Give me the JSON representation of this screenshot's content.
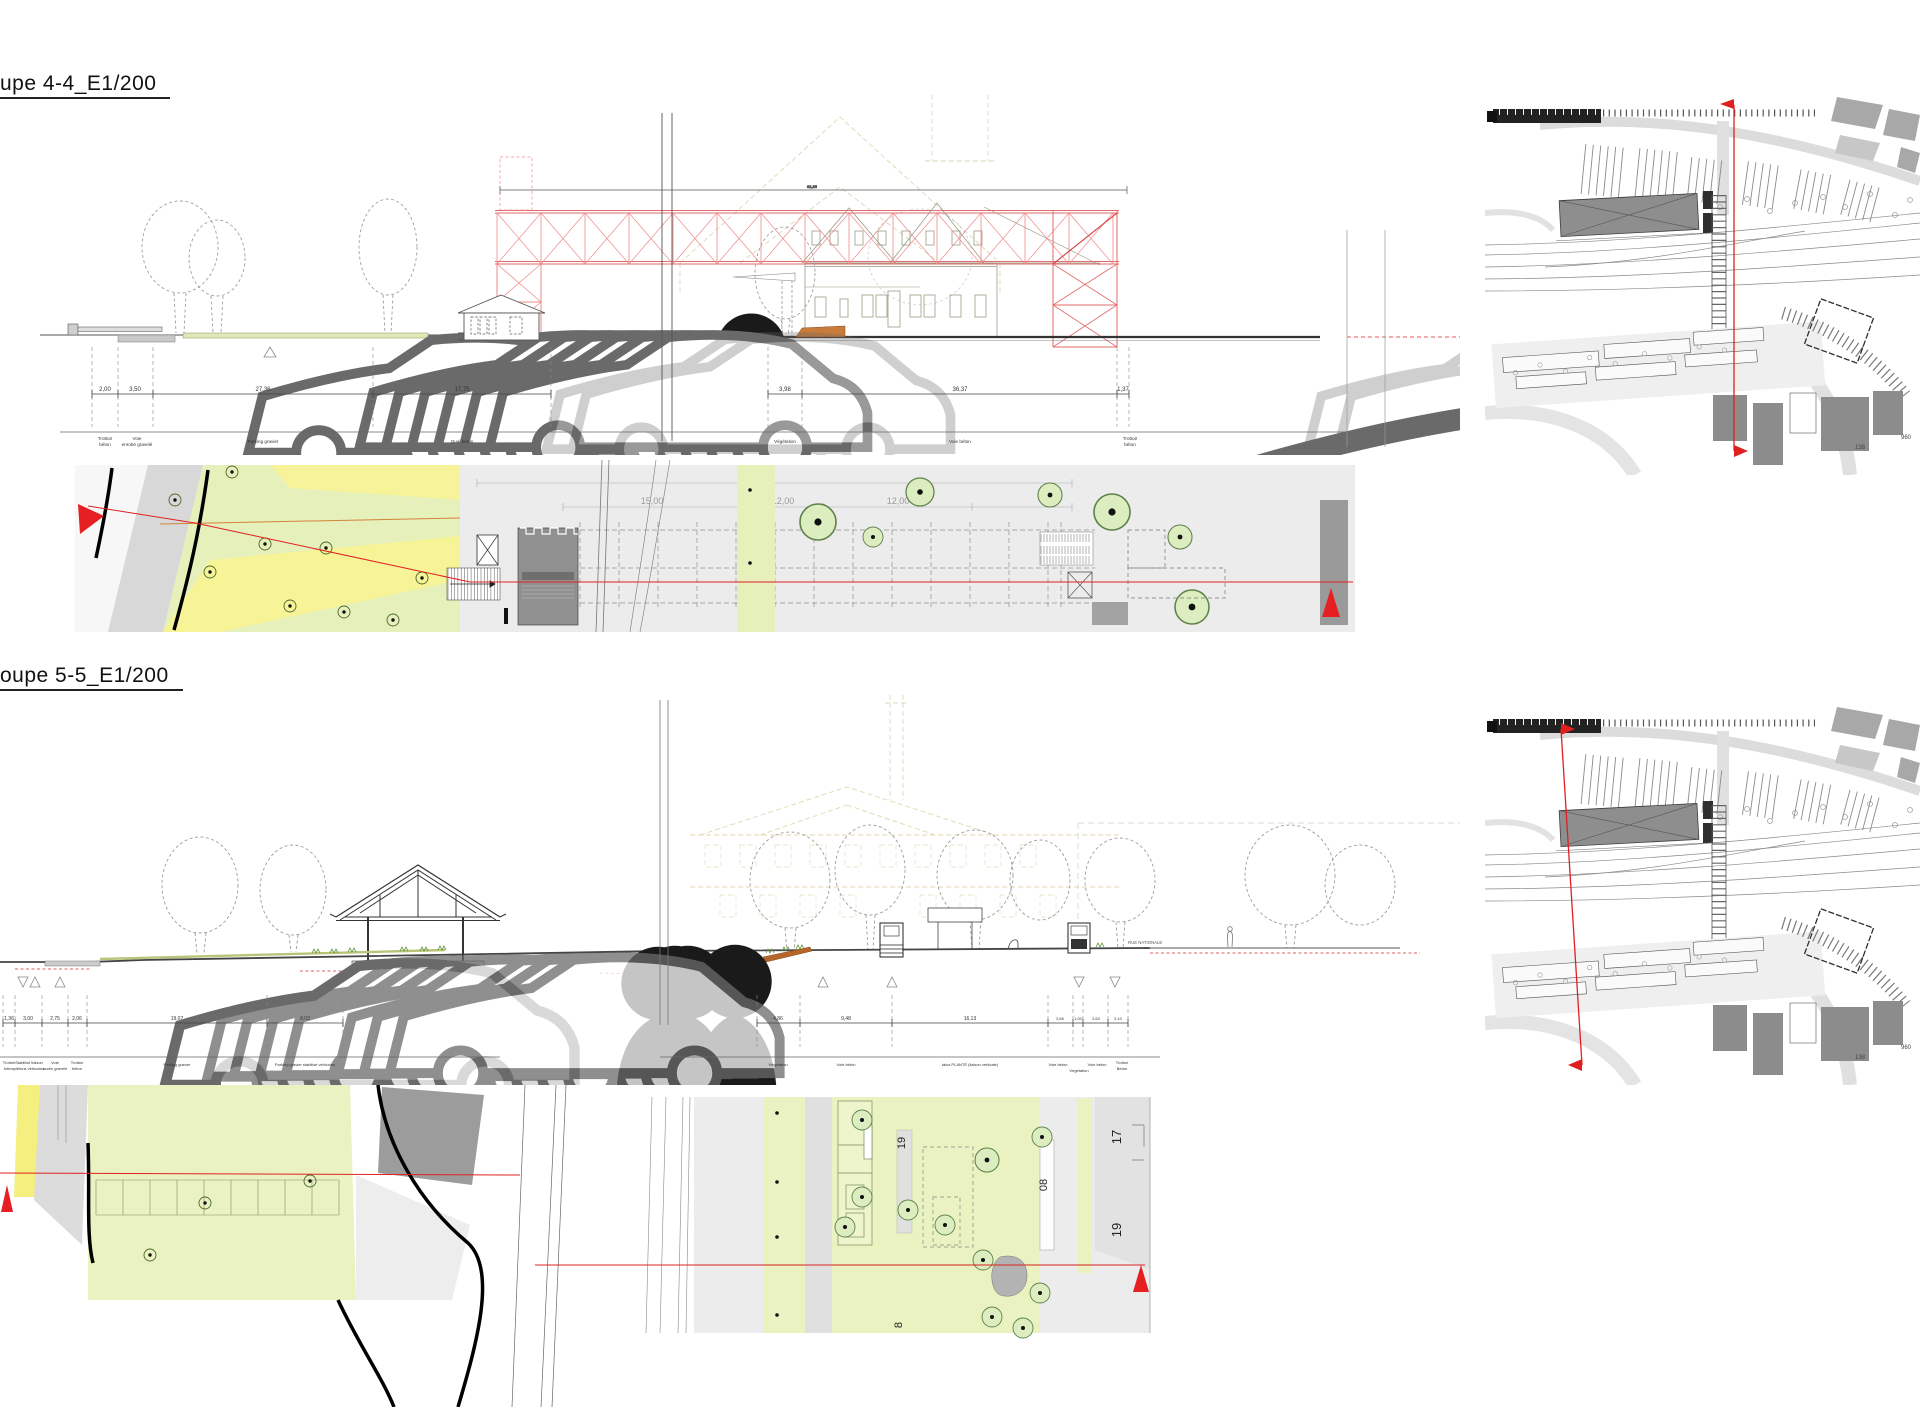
{
  "colors": {
    "section_line_red": "#e02020",
    "truss_red": "#ef8a8a",
    "marker_red": "#e51f22",
    "plan_green": "#e9f2c0",
    "plan_yellow": "#f4ef7e",
    "embankment_orange": "#b5672a",
    "plan_gray": "#ececec",
    "building_gray": "#8e8e8e"
  },
  "coupe44": {
    "title": "upe 4-4_E1/200",
    "top_dim": "62,35",
    "dim_values": [
      "2,00",
      "3,50",
      "27,36",
      "17,75",
      "3,98",
      "36,37",
      "1,37"
    ],
    "dim_labels": [
      {
        "a": "Trottoir",
        "b": "béton"
      },
      {
        "a": "Voie",
        "b": "enrobé gravelé"
      },
      {
        "a": "Parking gravier",
        "b": ""
      },
      {
        "a": "Quai béton",
        "b": ""
      },
      {
        "a": "Végétation",
        "b": ""
      },
      {
        "a": "Voie béton",
        "b": ""
      },
      {
        "a": "Trottoir",
        "b": "béton"
      }
    ],
    "plan_dims": [
      "15,00",
      "12,00",
      "12,00"
    ]
  },
  "coupe55": {
    "title": "oupe 5-5_E1/200",
    "dim_values": [
      "1,36",
      "3,00",
      "2,75",
      "2,06",
      "19,07",
      "8,03",
      "4,86",
      "9,48",
      "16,13",
      "2,66",
      "1,00",
      "2,63",
      "2,10"
    ],
    "dim_labels": [
      {
        "a": "Trottoir",
        "b": "béton"
      },
      {
        "a": "Stabilisé liaison",
        "b": "piétons véhicules"
      },
      {
        "a": "Voie",
        "b": "accès gravelé"
      },
      {
        "a": "Trottoir",
        "b": "béton"
      },
      {
        "a": "Parking gravier",
        "b": ""
      },
      {
        "a": "Parking gravier stabilisé véhicules",
        "b": ""
      },
      {
        "a": "Végétation",
        "b": ""
      },
      {
        "a": "Voie béton",
        "b": ""
      },
      {
        "a": "talus PLANTÉ (liaison verticale)",
        "b": ""
      },
      {
        "a": "Voie béton",
        "b": ""
      },
      {
        "a": "Végétation",
        "b": ""
      },
      {
        "a": "Voie béton",
        "b": ""
      },
      {
        "a": "Trottoir",
        "b": "Béton"
      }
    ],
    "street_label": "RUE NATIONALE",
    "plan_labels": [
      "19",
      "08",
      "8",
      "17",
      "19"
    ]
  },
  "maps": {
    "building_numbers": [
      "138",
      "960"
    ]
  }
}
